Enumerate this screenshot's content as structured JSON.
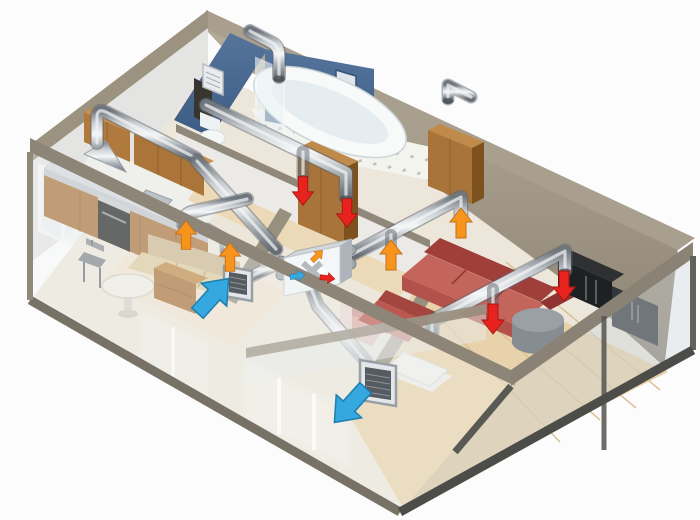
{
  "scene": {
    "title": "apartment-ventilation-isometric-cutaway",
    "background": "#fcfcfc",
    "palette": {
      "supply_air": "#f7941e",
      "supply_air_edge": "#c4721a",
      "extract_air": "#e8231f",
      "extract_air_edge": "#a81613",
      "fresh_air": "#35a8e0",
      "fresh_air_edge": "#1f7fb0",
      "duct_metal": "#c7cdd1",
      "wall_top": "#8d8577",
      "back_wall": "#9a9183",
      "bathroom_wall": "#4a6b94",
      "wood_cabinet": "#ab7439",
      "sofa_red": "#c4655c",
      "sofa_beige": "#d9c49a",
      "armchair_pink": "#dfb0a8",
      "glass_wall": "#dfe7ea"
    },
    "rooms": [
      {
        "name": "kitchen",
        "furniture": [
          "wall-cabinets",
          "range-hood",
          "stove",
          "counter",
          "sink",
          "dining-table",
          "chair"
        ]
      },
      {
        "name": "bathroom",
        "furniture": [
          "bathtub",
          "shower-screen",
          "toilet",
          "wall-niche",
          "wall-grille"
        ]
      },
      {
        "name": "hallway",
        "furniture": [
          "wardrobe",
          "tall-cabinet"
        ]
      },
      {
        "name": "bedroom-left",
        "furniture": [
          "daybed-sofa",
          "side-cabinet"
        ]
      },
      {
        "name": "bedroom-center",
        "furniture": [
          "armchair",
          "rug"
        ]
      },
      {
        "name": "living-room",
        "furniture": [
          "corner-sofa",
          "tv-cabinet",
          "storage-cabinet",
          "ottoman",
          "coffee-table"
        ]
      }
    ],
    "hrv_unit": {
      "name": "heat-recovery-ventilator",
      "face_symbols": [
        "fresh-air-arrow",
        "extract-air-arrow",
        "supply-air-arrow",
        "heat-exchanger-cross"
      ]
    },
    "grilles": [
      {
        "name": "fresh-air-intake-grille",
        "flow": "in"
      },
      {
        "name": "exhaust-outlet-grille",
        "flow": "out"
      }
    ],
    "airflow_arrows": [
      {
        "type": "supply",
        "x": 186,
        "y": 236,
        "rot": 0,
        "scale": 0.95
      },
      {
        "type": "supply",
        "x": 230,
        "y": 258,
        "rot": 0,
        "scale": 0.95
      },
      {
        "type": "supply",
        "x": 391,
        "y": 256,
        "rot": 0,
        "scale": 1.0
      },
      {
        "type": "supply",
        "x": 461,
        "y": 224,
        "rot": 0,
        "scale": 1.0
      },
      {
        "type": "extract",
        "x": 303,
        "y": 190,
        "rot": 180,
        "scale": 0.95
      },
      {
        "type": "extract",
        "x": 347,
        "y": 212,
        "rot": 180,
        "scale": 0.95
      },
      {
        "type": "extract",
        "x": 493,
        "y": 318,
        "rot": 180,
        "scale": 1.0
      },
      {
        "type": "extract",
        "x": 564,
        "y": 285,
        "rot": 180,
        "scale": 1.0
      },
      {
        "type": "fresh",
        "x": 212,
        "y": 297,
        "rot": 42,
        "scale": 1.55
      },
      {
        "type": "fresh",
        "x": 351,
        "y": 404,
        "rot": 222,
        "scale": 1.55
      },
      {
        "type": "fresh",
        "x": 297,
        "y": 276,
        "rot": 80,
        "scale": 0.5
      },
      {
        "type": "extract",
        "x": 327,
        "y": 278,
        "rot": 97,
        "scale": 0.5
      },
      {
        "type": "supply",
        "x": 317,
        "y": 256,
        "rot": 45,
        "scale": 0.5
      }
    ],
    "duct_runs": [
      "kitchen-hood-riser",
      "bathroom-extract-drop-1",
      "bathroom-extract-drop-2",
      "hall-extract-trunk",
      "return-trunk-to-unit",
      "supply-branch-right",
      "supply-branch-left",
      "living-room-extract-run",
      "exhaust-discharge-drop",
      "intake-link"
    ]
  }
}
